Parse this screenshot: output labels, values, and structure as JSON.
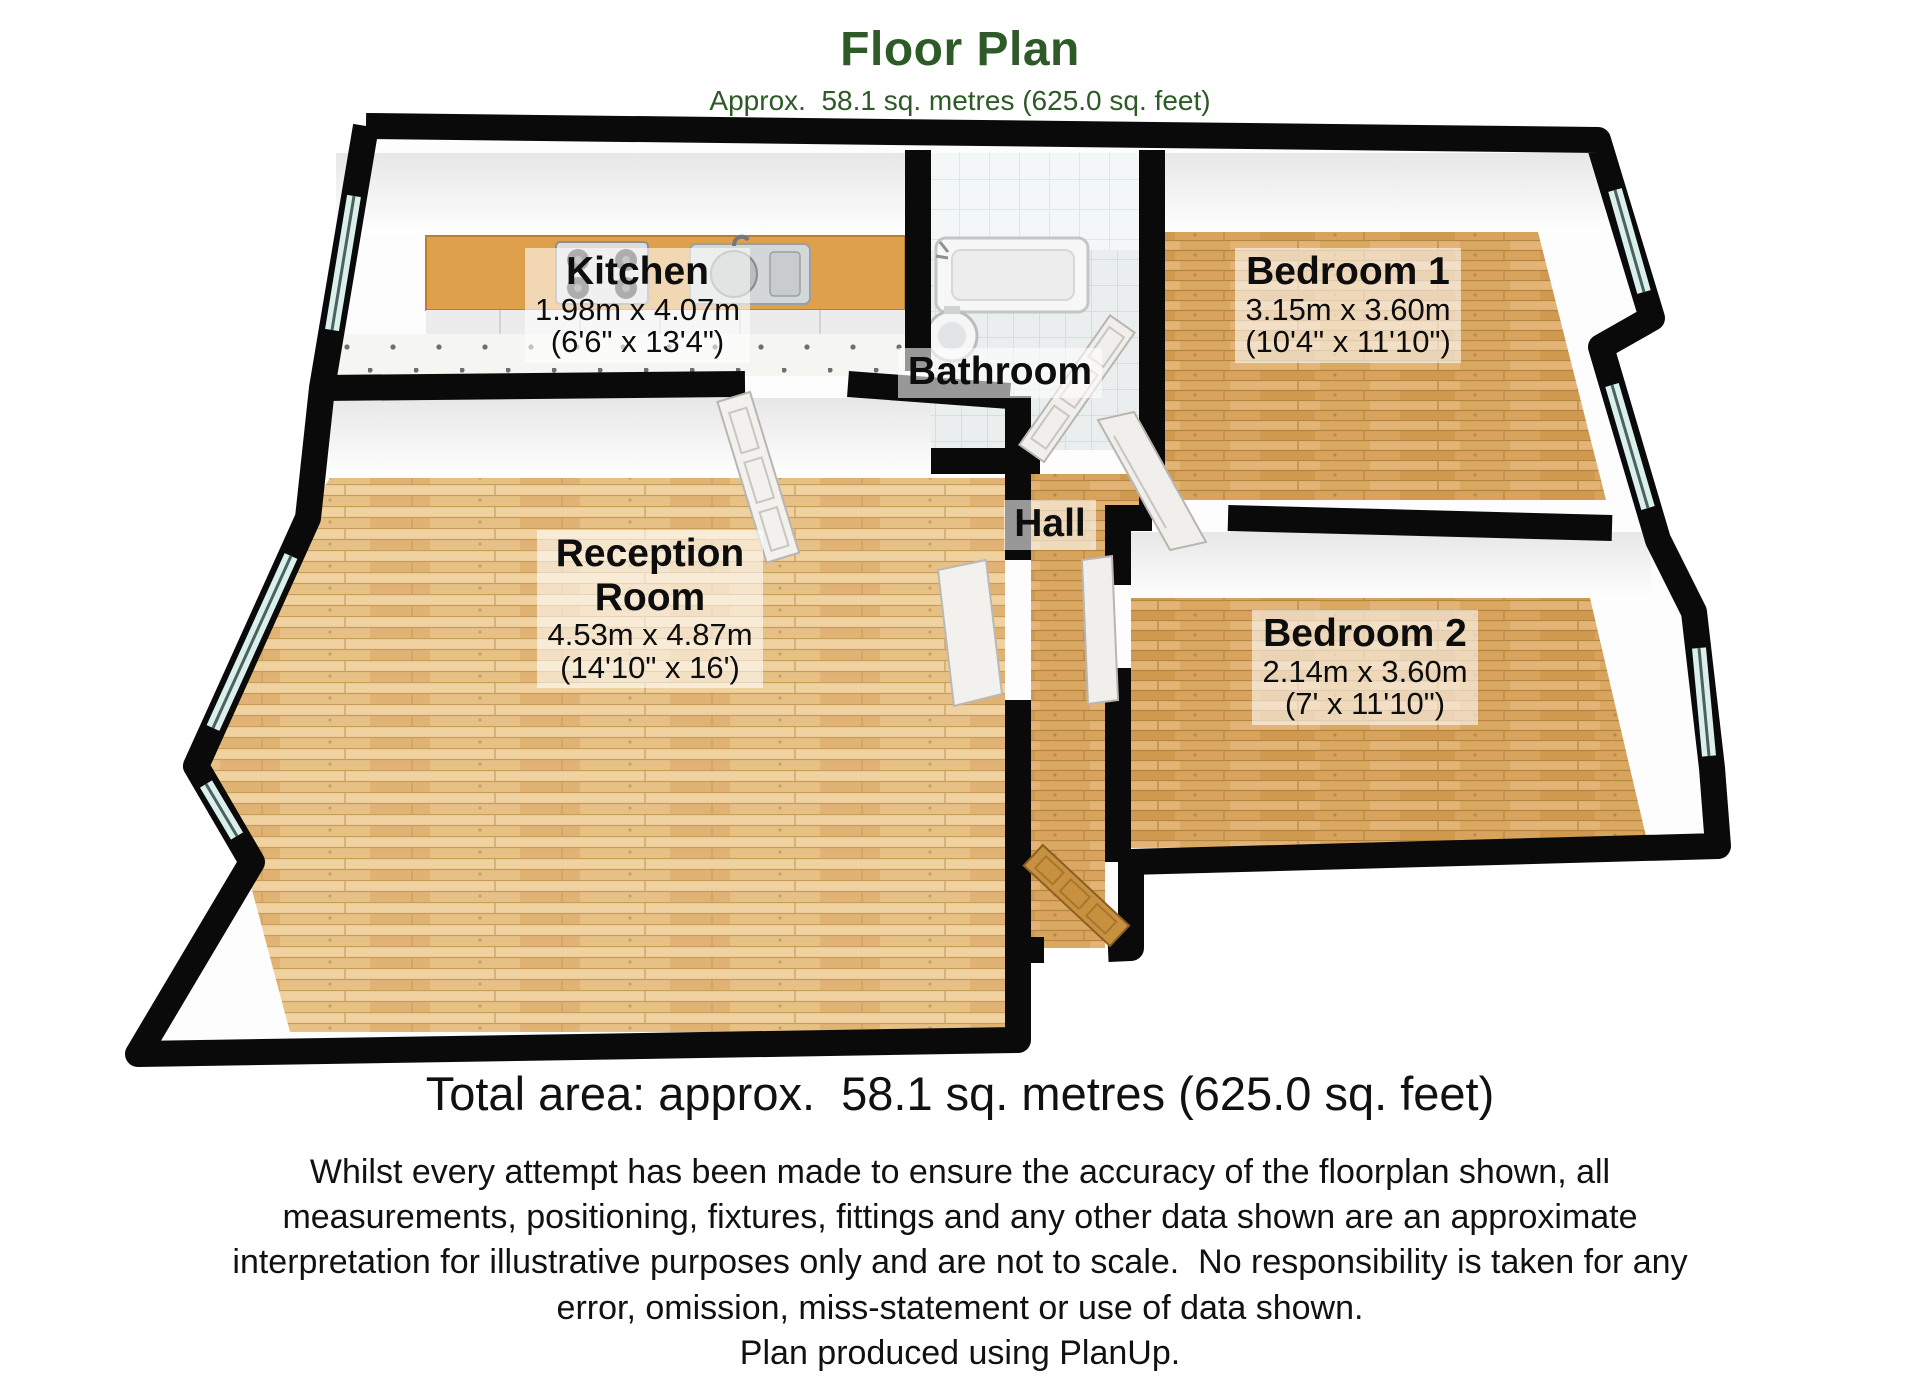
{
  "header": {
    "title": "Floor Plan",
    "subtitle": "Approx.  58.1 sq. metres (625.0 sq. feet)"
  },
  "rooms": {
    "kitchen": {
      "name": "Kitchen",
      "metric": "1.98m x 4.07m",
      "imperial": "(6'6\" x 13'4\")"
    },
    "bathroom": {
      "name": "Bathroom"
    },
    "bedroom1": {
      "name": "Bedroom 1",
      "metric": "3.15m x 3.60m",
      "imperial": "(10'4\" x 11'10\")"
    },
    "reception": {
      "name_line1": "Reception",
      "name_line2": "Room",
      "metric": "4.53m x 4.87m",
      "imperial": "(14'10\" x 16')"
    },
    "hall": {
      "name": "Hall"
    },
    "bedroom2": {
      "name": "Bedroom 2",
      "metric": "2.14m x 3.60m",
      "imperial": "(7' x 11'10\")"
    }
  },
  "footer": {
    "total_area": "Total area: approx.  58.1 sq. metres (625.0 sq. feet)",
    "disclaimer_lines": [
      "Whilst every attempt has been made to ensure the accuracy of the floorplan shown, all",
      "measurements, positioning, fixtures, fittings and any other data shown are an approximate",
      "interpretation for illustrative purposes only and are not to scale.  No responsibility is taken for any",
      "error, omission, miss-statement or use of data shown.",
      "Plan produced using PlanUp."
    ]
  },
  "colors": {
    "green": "#2d5a26",
    "wall": "#0a0a0a",
    "wood1": "#d8a35c",
    "wood2": "#e8c084",
    "glass": "#d9f0ec",
    "counter": "#dfa04b",
    "labelbg": "rgba(255,255,255,0.58)"
  }
}
